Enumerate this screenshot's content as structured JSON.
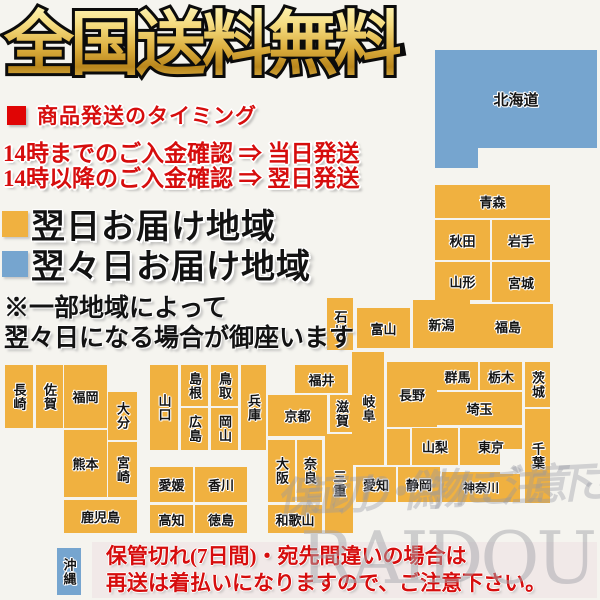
{
  "title": "全国送料無料",
  "shipping_timing": {
    "heading": "商品発送のタイミング",
    "lines": [
      "14時までのご入金確認 ⇒ 当日発送",
      "14時以降のご入金確認 ⇒ 翌日発送"
    ]
  },
  "legend": [
    {
      "label": "翌日お届け地域",
      "color_key": "orange"
    },
    {
      "label": "翌々日お届け地域",
      "color_key": "blue"
    }
  ],
  "note_lines": [
    "※一部地域によって",
    "翌々日になる場合が御座います"
  ],
  "warning_lines": [
    "保管切れ(7日間)・宛先間違いの場合は",
    "再送は着払いになりますので、ご注意下さい。"
  ],
  "watermark": {
    "script_text": "保証切り・偽物にご注意下さい",
    "logo_text": "RAIDOU"
  },
  "colors": {
    "orange": "#F0B140",
    "blue": "#76A5CF",
    "red": "#D60D0D",
    "title_gold": "#D9A93A",
    "warning_bg": "#F1E9E8",
    "background": "#F5F4EF"
  },
  "map": {
    "blocks": [
      {
        "id": "hokkaido",
        "label": "北海道",
        "x": 435,
        "y": 50,
        "w": 162,
        "h": 98,
        "color": "blue",
        "fs": 15
      },
      {
        "id": "hokkaido-tab",
        "label": "",
        "x": 435,
        "y": 148,
        "w": 43,
        "h": 20,
        "color": "blue"
      },
      {
        "id": "aomori",
        "label": "青森",
        "x": 435,
        "y": 185,
        "w": 115,
        "h": 33,
        "color": "orange"
      },
      {
        "id": "akita",
        "label": "秋田",
        "x": 435,
        "y": 220,
        "w": 55,
        "h": 40,
        "color": "orange"
      },
      {
        "id": "iwate",
        "label": "岩手",
        "x": 492,
        "y": 220,
        "w": 58,
        "h": 40,
        "color": "orange"
      },
      {
        "id": "yamagata",
        "label": "山形",
        "x": 435,
        "y": 262,
        "w": 55,
        "h": 38,
        "color": "orange"
      },
      {
        "id": "miyagi",
        "label": "宮城",
        "x": 492,
        "y": 262,
        "w": 58,
        "h": 40,
        "color": "orange"
      },
      {
        "id": "fukushima",
        "label": "福島",
        "x": 463,
        "y": 304,
        "w": 90,
        "h": 44,
        "color": "orange"
      },
      {
        "id": "niigata",
        "label": "新潟",
        "x": 413,
        "y": 300,
        "w": 57,
        "h": 48,
        "color": "orange"
      },
      {
        "id": "toyama",
        "label": "富山",
        "x": 357,
        "y": 308,
        "w": 53,
        "h": 40,
        "color": "orange"
      },
      {
        "id": "ishikawa",
        "label": "石川",
        "x": 327,
        "y": 298,
        "w": 26,
        "h": 52,
        "color": "orange",
        "v": 1
      },
      {
        "id": "gunma",
        "label": "群馬",
        "x": 437,
        "y": 362,
        "w": 41,
        "h": 28,
        "color": "orange"
      },
      {
        "id": "tochigi",
        "label": "栃木",
        "x": 480,
        "y": 362,
        "w": 42,
        "h": 28,
        "color": "orange"
      },
      {
        "id": "ibaraki",
        "label": "茨城",
        "x": 525,
        "y": 362,
        "w": 25,
        "h": 45,
        "color": "orange",
        "v": 1
      },
      {
        "id": "saitama",
        "label": "埼玉",
        "x": 437,
        "y": 392,
        "w": 85,
        "h": 33,
        "color": "orange"
      },
      {
        "id": "yamanashi",
        "label": "山梨",
        "x": 412,
        "y": 428,
        "w": 46,
        "h": 37,
        "color": "orange"
      },
      {
        "id": "tokyo",
        "label": "東京",
        "x": 460,
        "y": 428,
        "w": 62,
        "h": 37,
        "color": "orange"
      },
      {
        "id": "chiba",
        "label": "千葉",
        "x": 525,
        "y": 409,
        "w": 25,
        "h": 94,
        "color": "orange",
        "v": 1
      },
      {
        "id": "kanagawa",
        "label": "神奈川",
        "x": 442,
        "y": 472,
        "w": 78,
        "h": 30,
        "color": "orange",
        "fs": 12
      },
      {
        "id": "nagano",
        "label": "長野",
        "x": 387,
        "y": 362,
        "w": 50,
        "h": 65,
        "color": "orange"
      },
      {
        "id": "nagano-south",
        "label": "",
        "x": 387,
        "y": 429,
        "w": 23,
        "h": 36,
        "color": "orange"
      },
      {
        "id": "gifu",
        "label": "岐阜",
        "x": 352,
        "y": 352,
        "w": 32,
        "h": 113,
        "color": "orange",
        "v": 1
      },
      {
        "id": "shizuoka",
        "label": "静岡",
        "x": 398,
        "y": 467,
        "w": 42,
        "h": 35,
        "color": "orange"
      },
      {
        "id": "aichi",
        "label": "愛知",
        "x": 356,
        "y": 467,
        "w": 40,
        "h": 35,
        "color": "orange"
      },
      {
        "id": "fukui",
        "label": "福井",
        "x": 295,
        "y": 365,
        "w": 53,
        "h": 28,
        "color": "orange"
      },
      {
        "id": "kyoto",
        "label": "京都",
        "x": 268,
        "y": 395,
        "w": 59,
        "h": 41,
        "color": "orange"
      },
      {
        "id": "shiga",
        "label": "滋賀",
        "x": 330,
        "y": 395,
        "w": 23,
        "h": 37,
        "color": "orange",
        "v": 1
      },
      {
        "id": "osaka",
        "label": "大阪",
        "x": 268,
        "y": 440,
        "w": 27,
        "h": 62,
        "color": "orange",
        "v": 1
      },
      {
        "id": "nara",
        "label": "奈良",
        "x": 297,
        "y": 440,
        "w": 25,
        "h": 62,
        "color": "orange",
        "v": 1
      },
      {
        "id": "mie",
        "label": "三重",
        "x": 325,
        "y": 434,
        "w": 28,
        "h": 99,
        "color": "orange",
        "v": 1
      },
      {
        "id": "wakayama",
        "label": "和歌山",
        "x": 268,
        "y": 505,
        "w": 54,
        "h": 28,
        "color": "orange"
      },
      {
        "id": "hyogo",
        "label": "兵庫",
        "x": 241,
        "y": 365,
        "w": 25,
        "h": 85,
        "color": "orange",
        "v": 1
      },
      {
        "id": "tottori",
        "label": "鳥取",
        "x": 211,
        "y": 365,
        "w": 27,
        "h": 41,
        "color": "orange",
        "v": 1
      },
      {
        "id": "shimane",
        "label": "島根",
        "x": 181,
        "y": 365,
        "w": 27,
        "h": 41,
        "color": "orange",
        "v": 1
      },
      {
        "id": "okayama",
        "label": "岡山",
        "x": 211,
        "y": 408,
        "w": 27,
        "h": 42,
        "color": "orange",
        "v": 1
      },
      {
        "id": "hiroshima",
        "label": "広島",
        "x": 181,
        "y": 408,
        "w": 27,
        "h": 42,
        "color": "orange",
        "v": 1
      },
      {
        "id": "yamaguchi",
        "label": "山口",
        "x": 150,
        "y": 365,
        "w": 28,
        "h": 85,
        "color": "orange",
        "v": 1
      },
      {
        "id": "ehime",
        "label": "愛媛",
        "x": 150,
        "y": 467,
        "w": 43,
        "h": 35,
        "color": "orange"
      },
      {
        "id": "kagawa",
        "label": "香川",
        "x": 195,
        "y": 467,
        "w": 52,
        "h": 35,
        "color": "orange"
      },
      {
        "id": "kochi",
        "label": "高知",
        "x": 150,
        "y": 505,
        "w": 43,
        "h": 28,
        "color": "orange"
      },
      {
        "id": "tokushima",
        "label": "徳島",
        "x": 195,
        "y": 505,
        "w": 52,
        "h": 28,
        "color": "orange"
      },
      {
        "id": "nagasaki",
        "label": "長崎",
        "x": 5,
        "y": 365,
        "w": 28,
        "h": 63,
        "color": "orange",
        "v": 1
      },
      {
        "id": "saga",
        "label": "佐賀",
        "x": 36,
        "y": 365,
        "w": 27,
        "h": 63,
        "color": "orange",
        "v": 1
      },
      {
        "id": "fukuoka",
        "label": "福岡",
        "x": 64,
        "y": 365,
        "w": 43,
        "h": 63,
        "color": "orange"
      },
      {
        "id": "oita",
        "label": "大分",
        "x": 108,
        "y": 392,
        "w": 29,
        "h": 48,
        "color": "orange",
        "v": 1
      },
      {
        "id": "kumamoto",
        "label": "熊本",
        "x": 64,
        "y": 430,
        "w": 43,
        "h": 67,
        "color": "orange"
      },
      {
        "id": "miyazaki",
        "label": "宮崎",
        "x": 108,
        "y": 442,
        "w": 29,
        "h": 55,
        "color": "orange",
        "v": 1
      },
      {
        "id": "kagoshima",
        "label": "鹿児島",
        "x": 64,
        "y": 500,
        "w": 73,
        "h": 33,
        "color": "orange"
      },
      {
        "id": "okinawa",
        "label": "沖縄",
        "x": 57,
        "y": 548,
        "w": 24,
        "h": 47,
        "color": "blue",
        "v": 1
      }
    ]
  }
}
